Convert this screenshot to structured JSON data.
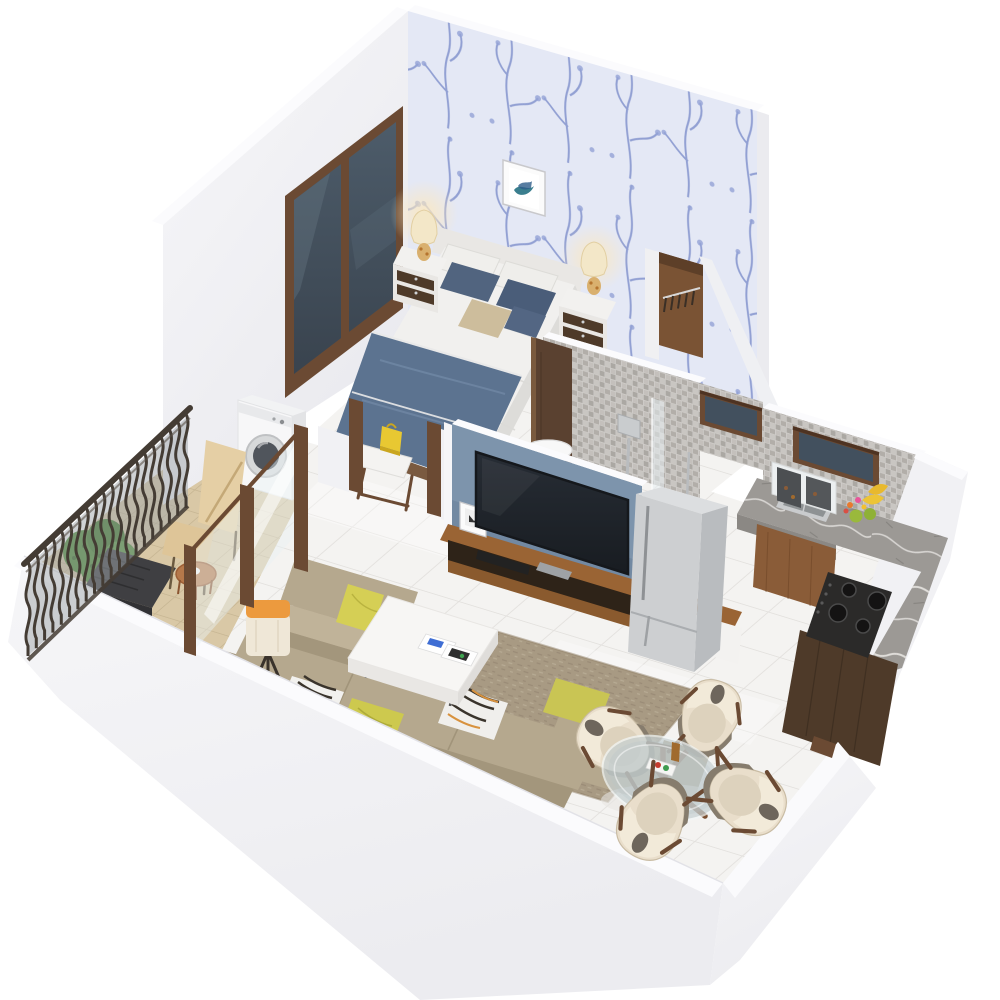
{
  "meta": {
    "description": "3D isometric cutaway render of a one-bedroom apartment floor plan on a plain white background",
    "view": "axonometric from above, no visible text"
  },
  "rooms": {
    "bedroom": {
      "contents": [
        "double-bed",
        "blue-blanket",
        "pillows",
        "nightstand-left",
        "nightstand-right",
        "table-lamp-left",
        "table-lamp-right",
        "wall-art",
        "floral-wallpaper-wall",
        "window",
        "open-wardrobe",
        "luggage-stool",
        "yellow-bag"
      ]
    },
    "bathroom": {
      "contents": [
        "mosaic-walls",
        "wood-door",
        "shower-mixer",
        "glass-partition",
        "washbasin",
        "clerestory-window"
      ]
    },
    "kitchen": {
      "contents": [
        "mosaic-backsplash",
        "clerestory-window",
        "l-shaped-granite-counter",
        "sink",
        "glass-wall-cabinet",
        "gas-hob",
        "fruit-cluster",
        "wood-base-cabinet",
        "dark-tall-cabinet"
      ]
    },
    "living_room": {
      "contents": [
        "blue-tv-wall",
        "television",
        "media-console",
        "photo-frame",
        "refrigerator",
        "armchair",
        "l-shaped-sofa",
        "throw-pillows",
        "coffee-table",
        "magazines",
        "tripod-floor-lamp",
        "area-rug",
        "tiled-floor"
      ]
    },
    "dining": {
      "contents": [
        "round-glass-table",
        "wood-cross-base",
        "four-shell-chairs",
        "condiment-set"
      ]
    },
    "balcony": {
      "contents": [
        "wrought-iron-railing",
        "terracotta-tile-floor",
        "washing-machine",
        "sliding-glass-door",
        "lounge-chair",
        "rattan-side-table",
        "green-shrub",
        "dark-planter-bench"
      ]
    }
  },
  "palette": {
    "background": "#ffffff",
    "wall_face": "#f3f3f6",
    "wall_face_shaded": "#ebebef",
    "wall_top": "#fbfbfd",
    "outer_mass": "#f1f1f4",
    "floor_tile": "#f4f3f1",
    "balcony_tile": "#d9c8a6",
    "wallpaper_base": "#e4e8f5",
    "wallpaper_motif": "#6f82c4",
    "wood_frame": "#6b4a33",
    "wood_dark": "#4e3a29",
    "wood_mid": "#8a5c38",
    "wood_console": "#9a6434",
    "wardrobe_wood": "#7a5334",
    "door_wood": "#5a4130",
    "glass_dark": "#42505e",
    "glass_pane": "#e9f1f4",
    "tv_wall": "#7d94ac",
    "tv_screen": "#20242a",
    "mosaic_base": "#bab6b1",
    "marble": "#9c9995",
    "steel": "#c9cbcd",
    "hob": "#2b2a29",
    "sofa": "#b5a88e",
    "sofa_dark": "#a3967c",
    "rug": "#a89a83",
    "pillow_yellow": "#d5cf55",
    "pillow_blue": "#51647f",
    "blanket": "#5c7390",
    "bedding": "#f1f0ee",
    "fridge": "#cdcfd1",
    "chair_cream": "#e9decb",
    "lounge_cream": "#e5cfa5",
    "railing": "#443c34",
    "plant": "#4c8a34",
    "lamp_orange": "#ec9a3e",
    "lamp_shade": "#f3e7c8",
    "bench_dark": "#3f3f42"
  }
}
